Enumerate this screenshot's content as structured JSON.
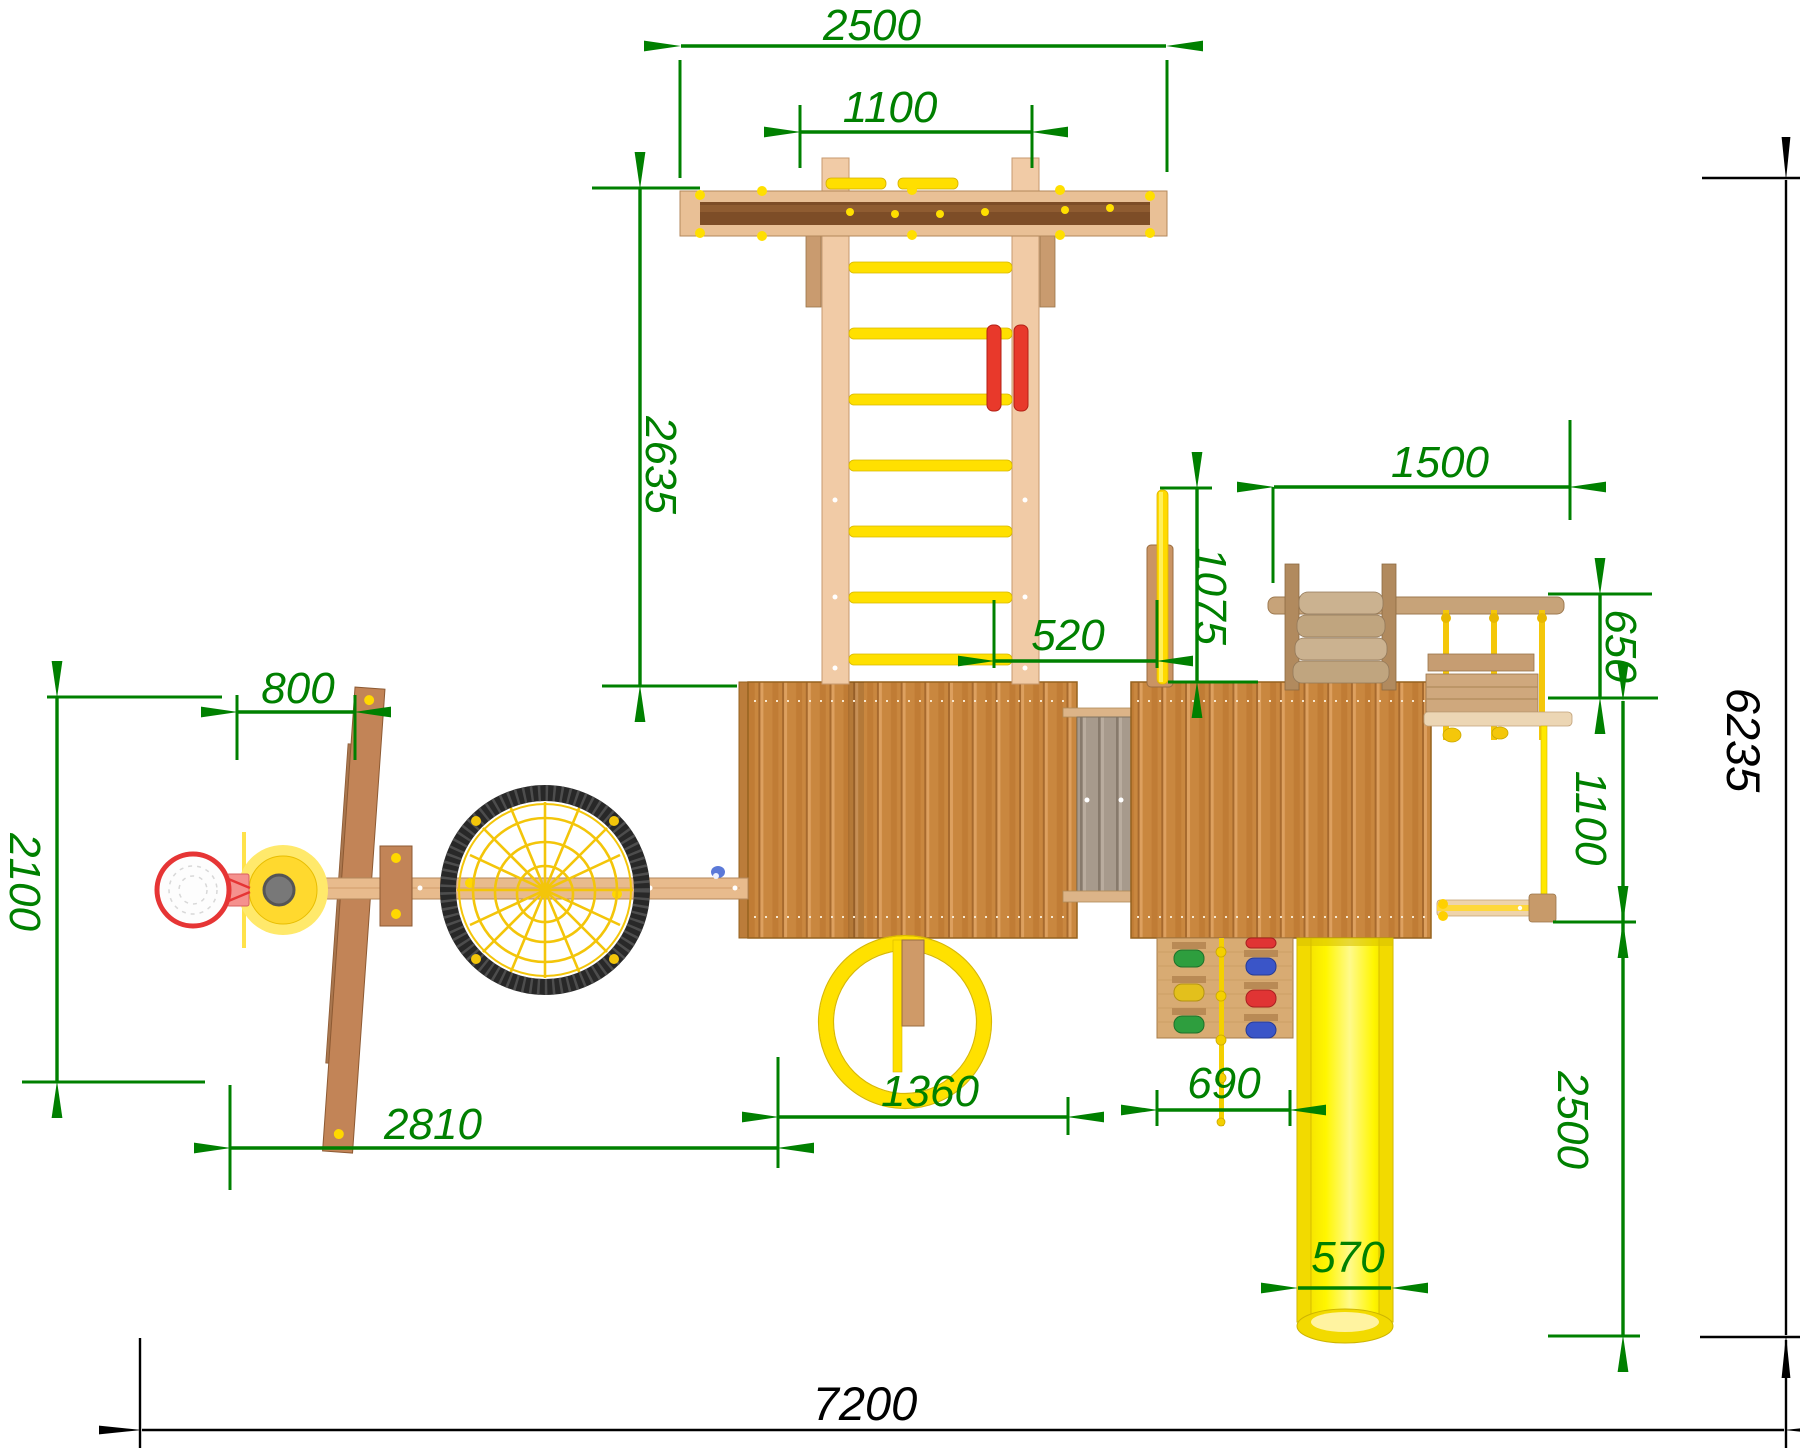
{
  "drawing": {
    "kind": "playground-set-top-view-technical-drawing",
    "units": "mm",
    "colors": {
      "dimension_green": "#008000",
      "dimension_black": "#000000",
      "wood_beam": "#e9c096",
      "wood_dark_core": "#7d4d27",
      "wood_roof": "#c9873f",
      "wood_post": "#c28457",
      "bridge_gray": "#a79a8c",
      "accent_yellow": "#ffe000",
      "slide_yellow": "#fff200",
      "accent_red": "#e8392b",
      "nest_ring_black": "#282828"
    },
    "components": [
      "swing-beam",
      "gym-ladder",
      "left-tower-roof",
      "bridge",
      "right-tower-roof",
      "climbing-ramp",
      "rope-ladder",
      "fireman-pole",
      "basketball-hoop",
      "swing-frame",
      "nest-swing",
      "ring-swing",
      "climbing-wall",
      "slide"
    ]
  },
  "dims": {
    "swing_beam_length": "2500",
    "ladder_width": "1100",
    "ladder_length": "2635",
    "right_module_length": "1500",
    "fireman_pole_offset": "1075",
    "bridge_length": "520",
    "rope_ladder_depth": "650",
    "swing_station_depth": "1100",
    "basketball_offset": "800",
    "swing_zone_depth": "2100",
    "swing_zone_length": "2810",
    "ring_offset": "1360",
    "climbing_wall_width": "690",
    "slide_length": "2500",
    "slide_width": "570",
    "total_depth": "6235",
    "total_length": "7200"
  }
}
